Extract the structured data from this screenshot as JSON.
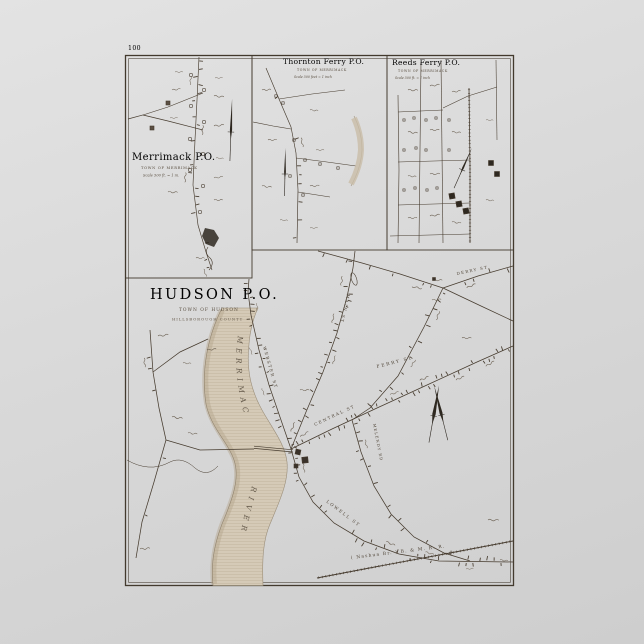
{
  "poster": {
    "page_number": "100",
    "insets": {
      "merrimack": {
        "title": "Merrimack P.O.",
        "subtitle": "TOWN OF MERRIMACK",
        "scale": "Scale 500 ft. = 1 in."
      },
      "thornton": {
        "title": "Thornton Ferry P.O.",
        "subtitle": "TOWN OF MERRIMACK",
        "scale": "Scale 500 feet = 1 inch"
      },
      "reeds": {
        "title": "Reeds Ferry P.O.",
        "subtitle": "TOWN OF MERRIMACK",
        "scale": "Scale 500 ft. = 1 inch"
      }
    },
    "hudson": {
      "title": "HUDSON P.O.",
      "subtitle": "TOWN OF HUDSON",
      "county": "HILLSBOROUGH COUNTY"
    },
    "river": {
      "name_upper": "MERRIMAC",
      "name_lower": "RIVER"
    },
    "streets": {
      "webster": "WEBSTER ST",
      "main": "MAIN ST",
      "central": "CENTRAL ST",
      "ferry": "FERRY ST",
      "derry": "DERRY ST",
      "lowell": "LOWELL ST",
      "melendy": "MELENDY RD"
    },
    "railroad": "( Nashua Br. )   B. & M.  R. R.",
    "colors": {
      "paper": "#f0dfba",
      "ink": "#463b2e",
      "river": "#d5cab7",
      "background": "#d9d9d9"
    }
  }
}
